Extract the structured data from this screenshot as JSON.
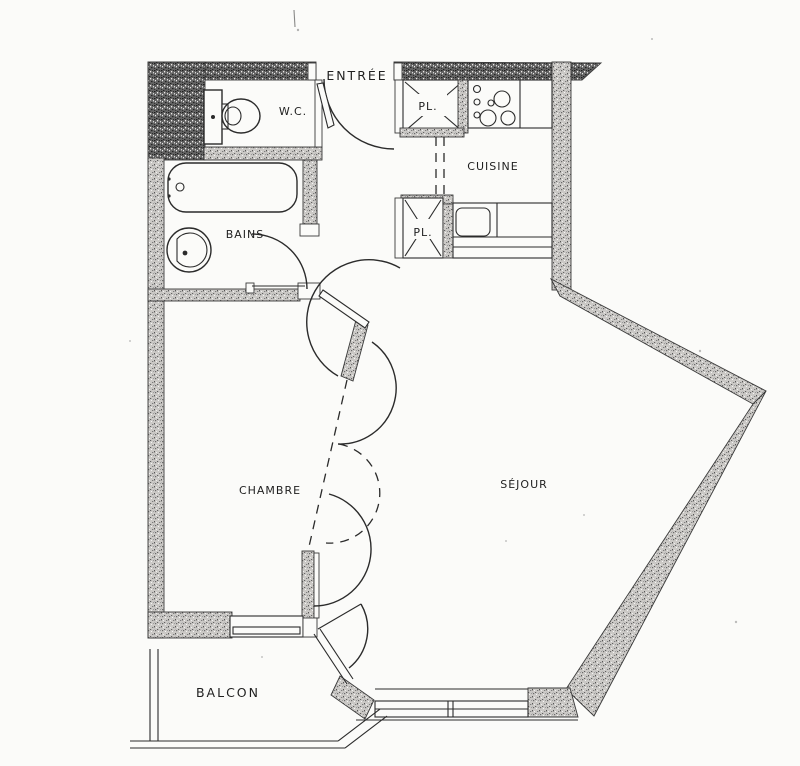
{
  "colors": {
    "paper": "#fbfbf9",
    "ink": "#1f1f1f"
  },
  "labels": {
    "entree": "ENTRÉE",
    "wc": "W.C.",
    "placard_haut": "PL.",
    "cuisine": "CUISINE",
    "placard_bas": "PL.",
    "bains": "BAINS",
    "chambre": "CHAMBRE",
    "sejour": "SÉJOUR",
    "balcon": "BALCON"
  }
}
